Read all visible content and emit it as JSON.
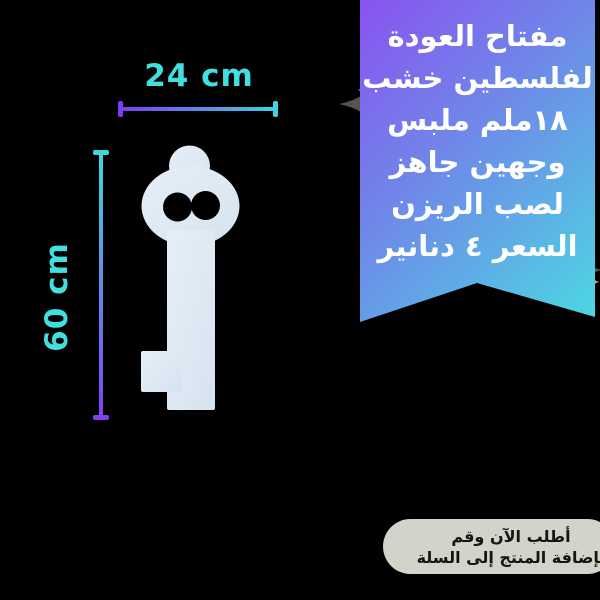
{
  "background_color": "#000000",
  "dimensions": {
    "width_label": "24 cm",
    "height_label": "60 cm",
    "label_color": "#43dfe0",
    "line_gradient_purple": "#7a3df2",
    "line_gradient_teal": "#3fd2e2"
  },
  "product": {
    "description": "white wooden key-of-return cutout silhouette",
    "shape_color": "#dde9f3"
  },
  "ribbon": {
    "gradient_start": "#8a52f0",
    "gradient_end": "#4cd8e2",
    "text_color": "#ffffff",
    "lines": [
      "مفتاح العودة",
      "لفلسطين خشب",
      "١٨ملم ملبس",
      "وجهين جاهز",
      "لصب الريزن",
      "السعر ٤ دنانير"
    ]
  },
  "cta": {
    "background": "#d3d4c9",
    "text_color": "#16160f",
    "lines": [
      "أطلب الآن وقم",
      "بإضافة المنتج إلى السلة"
    ]
  },
  "sparkles": {
    "dark_color": "#57524a",
    "accent_color": "#eda03f"
  }
}
